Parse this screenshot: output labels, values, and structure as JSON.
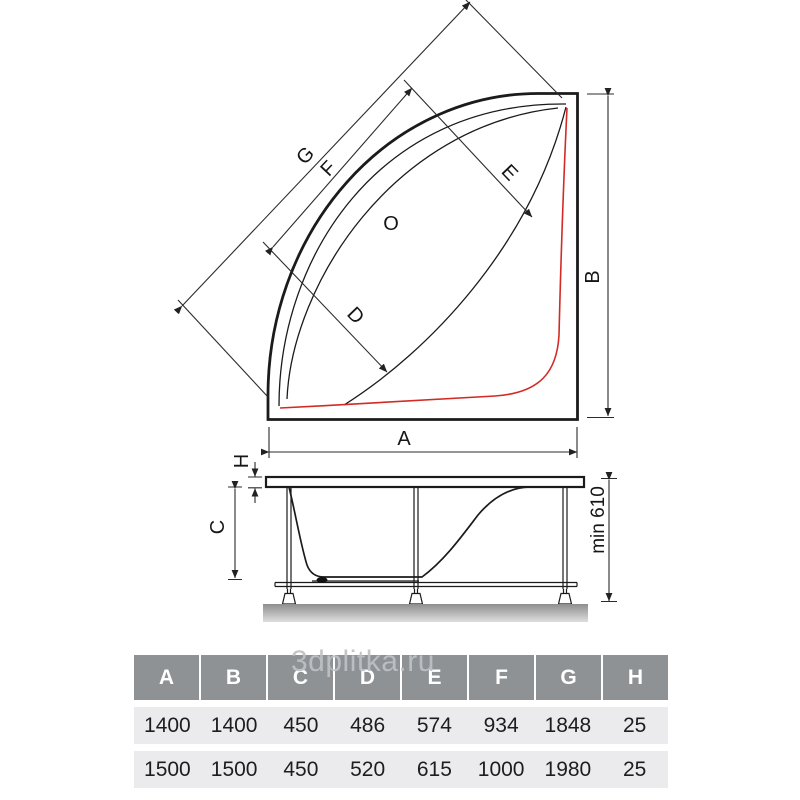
{
  "watermark": "3dplitka.ru",
  "diagram": {
    "labels": {
      "g": "G",
      "f": "F",
      "e": "E",
      "d": "D",
      "o": "O",
      "a": "A",
      "b": "B",
      "h": "H",
      "c": "C",
      "min_height": "min 610"
    },
    "colors": {
      "line": "#1b1b1b",
      "dimension": "#2b2b2b",
      "accent_red": "#d22b25"
    }
  },
  "table": {
    "headers": [
      "A",
      "B",
      "C",
      "D",
      "E",
      "F",
      "G",
      "H"
    ],
    "rows": [
      [
        "1400",
        "1400",
        "450",
        "486",
        "574",
        "934",
        "1848",
        "25"
      ],
      [
        "1500",
        "1500",
        "450",
        "520",
        "615",
        "1000",
        "1980",
        "25"
      ]
    ]
  }
}
